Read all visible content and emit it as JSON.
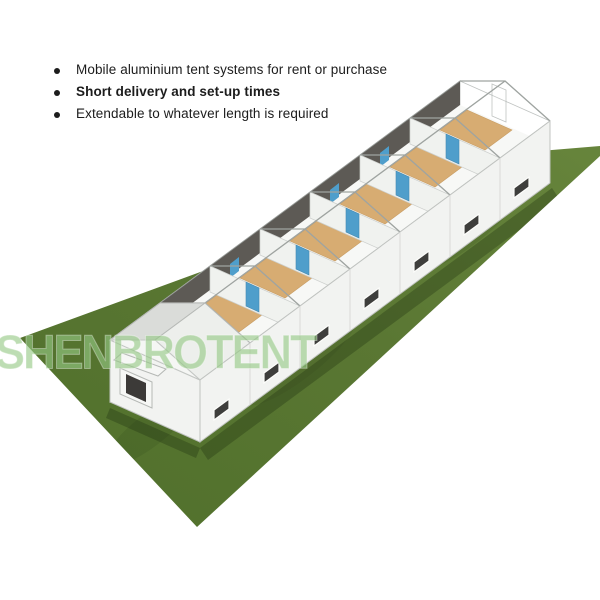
{
  "page": {
    "background": "#ffffff"
  },
  "bullets": {
    "items": [
      {
        "text": "Mobile aluminium tent systems for rent or purchase",
        "bold": false
      },
      {
        "text": "Short delivery and set-up times",
        "bold": true
      },
      {
        "text": "Extendable to whatever length is required",
        "bold": false
      }
    ]
  },
  "watermark": {
    "text": "SHENBROTENT",
    "color": "#94c886"
  },
  "illustration": {
    "subject": "3D render of a long modular aluminium tent system with open transparent gable-roof frames, white walls, interior partitions with blue doors, wood floor panels and small dark windows, standing on a green grass field",
    "module_count": 7,
    "colors": {
      "grass": "#5a7733",
      "walls": "#f2f3f1",
      "wood_floor": "#d2a05e",
      "doors": "#3590c4",
      "roof_frame": "#9fa4a1",
      "window_glass": "#3e3e3c"
    }
  }
}
